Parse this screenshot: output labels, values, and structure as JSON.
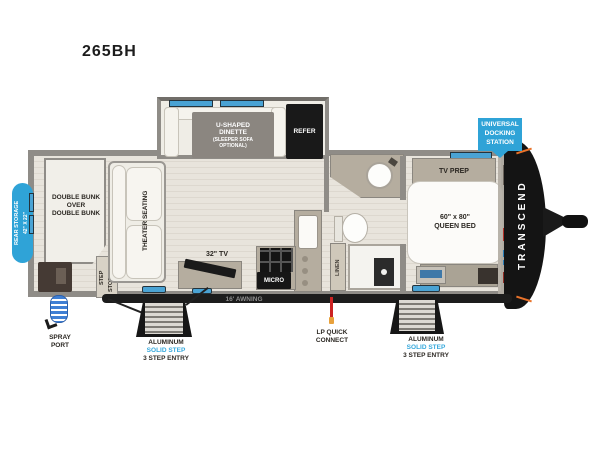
{
  "title": "265BH",
  "colors": {
    "badge_blue": "#2FA3D7",
    "solid_step_blue": "#35A8DC",
    "window_blue": "#4AA3D4",
    "front_cap_black": "#141414",
    "accent_orange": "#E8722A",
    "lp_line_red": "#CC2222"
  },
  "badges": {
    "rear_storage": [
      "REAR STORAGE",
      "42\" X 22\""
    ],
    "docking_station": [
      "UNIVERSAL",
      "DOCKING",
      "STATION"
    ]
  },
  "interior": {
    "bunk": [
      "DOUBLE BUNK",
      "OVER",
      "DOUBLE BUNK"
    ],
    "theater_seating": "THEATER SEATING",
    "step_storage": [
      "STEP",
      "STORAGE"
    ],
    "dinette": [
      "U-SHAPED",
      "DINETTE",
      "(SLEEPER SOFA",
      "OPTIONAL)"
    ],
    "refer": "REFER",
    "tv": "32\" TV",
    "micro": "MICRO",
    "linen": "LINEN",
    "tv_prep": "TV PREP",
    "queen_bed": [
      "60\" x 80\"",
      "QUEEN BED"
    ],
    "brand": "TRANSCEND"
  },
  "exterior": {
    "awning": "16' AWNING",
    "spray_port": [
      "SPRAY",
      "PORT"
    ],
    "lp_connect": [
      "LP QUICK",
      "CONNECT"
    ],
    "entry_left": [
      "ALUMINUM",
      "SOLID STEP",
      "3 STEP ENTRY"
    ],
    "entry_right": [
      "ALUMINUM",
      "SOLID STEP",
      "3 STEP ENTRY"
    ]
  }
}
